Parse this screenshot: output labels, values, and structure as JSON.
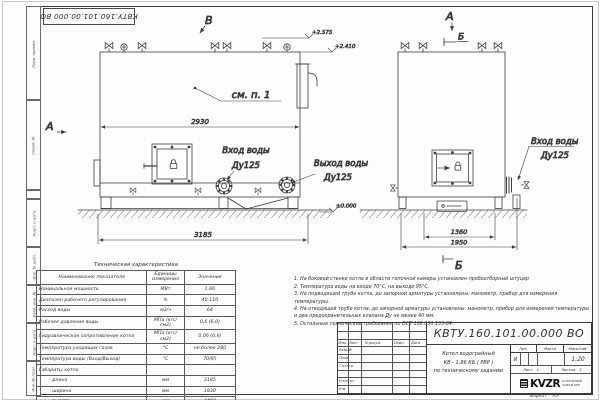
{
  "sheet": {
    "format_label": "Формат",
    "format_value": "А3"
  },
  "stamp_top": {
    "doc_number": "КВТУ.160.101.00.000 ВО"
  },
  "frame": {
    "left_labels": [
      "Перв. примен.",
      "Справ. №",
      "Подп. и дата",
      "Инв. № дубл.",
      "Взам. инв. №",
      "Подп. и дата",
      "Инв. № подл."
    ]
  },
  "drawing": {
    "view_v": "В",
    "view_a_left": "А",
    "view_a_right": "А",
    "view_b_top": "Б",
    "view_b_bottom": "Б",
    "see_note": "см. п. 1",
    "elev_top1": "+2.575",
    "elev_top2": "+2.410",
    "elev_zero": "±0.000",
    "dim_front_width": "2930",
    "dim_front_overall": "3185",
    "dim_side_width": "1360",
    "dim_side_overall": "1950",
    "inlet_front_l1": "Вход воды",
    "inlet_front_l2": "Ду125",
    "outlet_front_l1": "Выход воды",
    "outlet_front_l2": "Ду125",
    "inlet_side_l1": "Вход воды",
    "inlet_side_l2": "Ду125"
  },
  "tech_table": {
    "title": "Техническая характеристика",
    "headers": [
      "Наименование показателя",
      "Единицы измерения",
      "Значение"
    ],
    "rows": [
      [
        "Номинальная мощность",
        "МВт",
        "1,86"
      ],
      [
        "Диапазон рабочего регулирования",
        "%",
        "40-110"
      ],
      [
        "Расход воды",
        "м3/ч",
        "64"
      ],
      [
        "Рабочее давление воды",
        "МПа (кгс/см2)",
        "0,6 (6,0)"
      ],
      [
        "Гидравлическое сопротивление котла",
        "МПа (кгс/см2)",
        "0,06 (0,6)"
      ],
      [
        "Температура уходящих газов",
        "°С",
        "не более 280"
      ],
      [
        "Температура воды (Вход/Выход)",
        "°С",
        "70/95"
      ],
      [
        "Габариты котла",
        "",
        ""
      ],
      [
        "- длина",
        "мм",
        "3185"
      ],
      [
        "- ширина",
        "мм",
        "1830"
      ],
      [
        "- высота",
        "мм",
        "2460"
      ]
    ]
  },
  "notes": {
    "items": [
      "1.  На боковой стенке котла в области топочной камеры установлен пробоотборный штуцер",
      "2.  Температура воды на входе 70°С, на выходе 95°С.",
      "3.  На подводящей трубе котла, до запорной арматуры установлены: манометр, прибор для измерения температуры.",
      "4.  На отводящей трубе котла, до запорной арматуры установлены: манометр, прибор для измерения температуры и два предохранительных клапана Ду не менее 40 мм.",
      "5.  Остальные технические требования по ОСТ 108.030.133-84."
    ]
  },
  "title_block": {
    "doc_number": "КВТУ.160.101.00.000  ВО",
    "product_line1": "Котел водогрейный",
    "product_line2": "КВ - 1,86  КБ  ( РВР )",
    "product_line3": "по техническому заданию",
    "col_izm": "Изм.",
    "col_list": "Лист",
    "col_doc": "N докум.",
    "col_podp": "Подп.",
    "col_data": "Дата",
    "row_razrab": "Разраб.",
    "row_prov": "Пров.",
    "row_tkontr": "Т.контр.",
    "row_nkontr": "Н.контр.",
    "row_utv": "Утв.",
    "lit_label": "Лит.",
    "lit_value": "И",
    "mass_label": "Масса",
    "scale_label": "Масштаб",
    "scale_value": "1:20",
    "sheet_label": "Лист",
    "sheet_value": "1",
    "sheets_label": "Листов",
    "sheets_value": "2",
    "logo_text": "KVZR",
    "company_line1": "КОТЕЛЬНЫЙ",
    "company_line2": "ЗАВОД РЭП"
  }
}
